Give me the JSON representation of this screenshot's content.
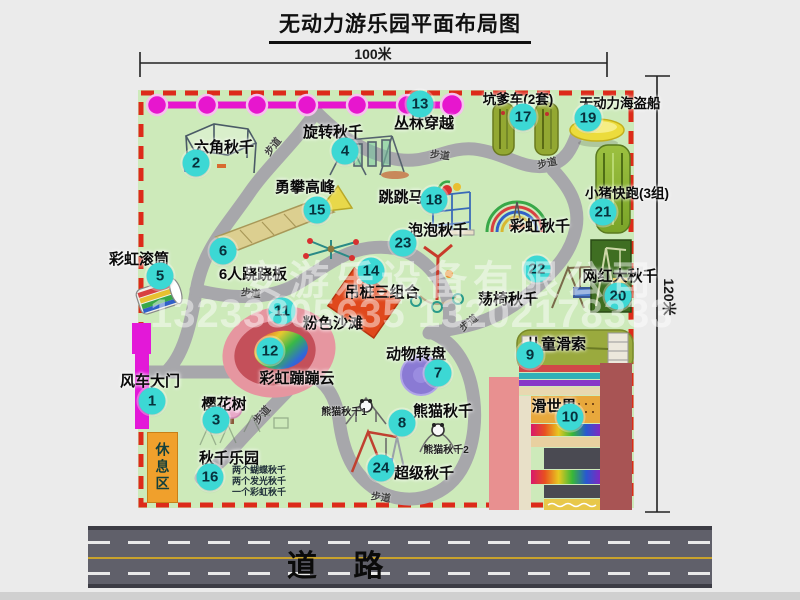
{
  "title": "无动力游乐园平面布局图",
  "dimensions": {
    "top": "100米",
    "right": "120米"
  },
  "road": {
    "label": "道 路"
  },
  "rest_area_label": "休息区",
  "path_label": "步道",
  "watermark": {
    "company": "安游乐设备有限公司",
    "phone": "13233805635 13202178333"
  },
  "colors": {
    "park_green": "#cdeaba",
    "border_red": "#dd2a1a",
    "badge_cyan": "#3cd8d4",
    "magenta": "#e716ce",
    "road_gray": "#60606a",
    "rest_orange": "#f0a02c"
  },
  "attractions": [
    {
      "num": "1",
      "label": "风车大门"
    },
    {
      "num": "2",
      "label": "六角秋千"
    },
    {
      "num": "3",
      "label": "樱花树"
    },
    {
      "num": "4",
      "label": "旋转秋千"
    },
    {
      "num": "5",
      "label": "彩虹滚筒"
    },
    {
      "num": "6",
      "label": "6人跷跷板"
    },
    {
      "num": "7",
      "label": "动物转盘"
    },
    {
      "num": "8",
      "label": "熊猫秋千"
    },
    {
      "num": "9",
      "label": "儿童滑索"
    },
    {
      "num": "10",
      "label": "滑世界"
    },
    {
      "num": "11",
      "label": "粉色沙滩"
    },
    {
      "num": "12",
      "label": "彩虹蹦蹦云"
    },
    {
      "num": "13",
      "label": "丛林穿越"
    },
    {
      "num": "14",
      "label": "吊桩三组合"
    },
    {
      "num": "15",
      "label": "勇攀高峰"
    },
    {
      "num": "16",
      "label": "秋千乐园"
    },
    {
      "num": "17",
      "label": "坑爹车(2套)"
    },
    {
      "num": "18",
      "label": "跳跳马"
    },
    {
      "num": "19",
      "label": "无动力海盗船"
    },
    {
      "num": "20",
      "label": "网红大秋千"
    },
    {
      "num": "21",
      "label": "小猪快跑(3组)"
    },
    {
      "num": "22",
      "label": "荡椅秋千"
    },
    {
      "num": "23",
      "label": "泡泡秋千"
    },
    {
      "num": "24",
      "label": "超级秋千"
    }
  ],
  "extra_labels": {
    "rainbow_swing": "彩虹秋千"
  },
  "small_labels": {
    "panda1": "熊猫秋千1",
    "panda2": "熊猫秋千2",
    "swing_park_items": [
      "两个蝴蝶秋千",
      "两个发光秋千",
      "一个彩虹秋千"
    ]
  }
}
